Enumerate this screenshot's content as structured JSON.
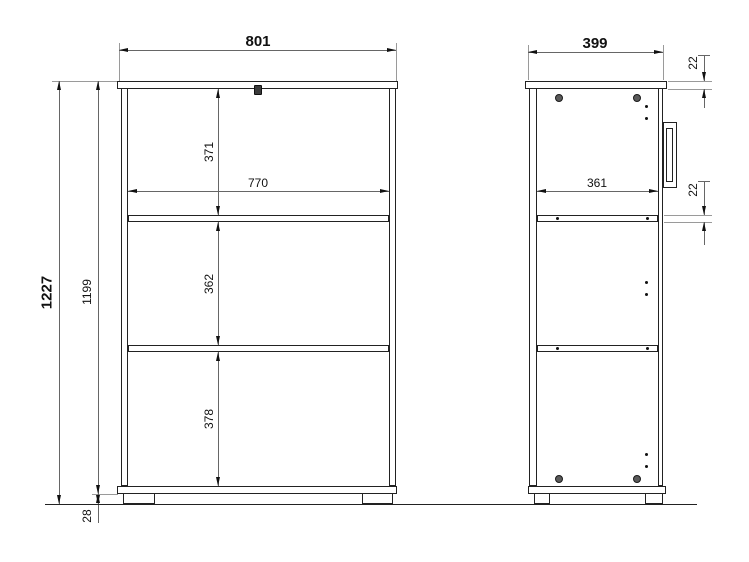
{
  "dims": {
    "front": {
      "width": "801",
      "opening_width": "770",
      "total_height": "1227",
      "body_height": "1199",
      "top_compartment": "371",
      "middle_compartment": "362",
      "bottom_compartment": "378",
      "plinth_height": "28"
    },
    "side": {
      "depth": "399",
      "opening_depth": "361",
      "top_panel_thickness": "22",
      "shelf_thickness": "22"
    }
  },
  "colors": {
    "object_line": "#222222",
    "dimension_line": "#666666",
    "extension_line": "#9a9a9a",
    "background": "#ffffff"
  }
}
